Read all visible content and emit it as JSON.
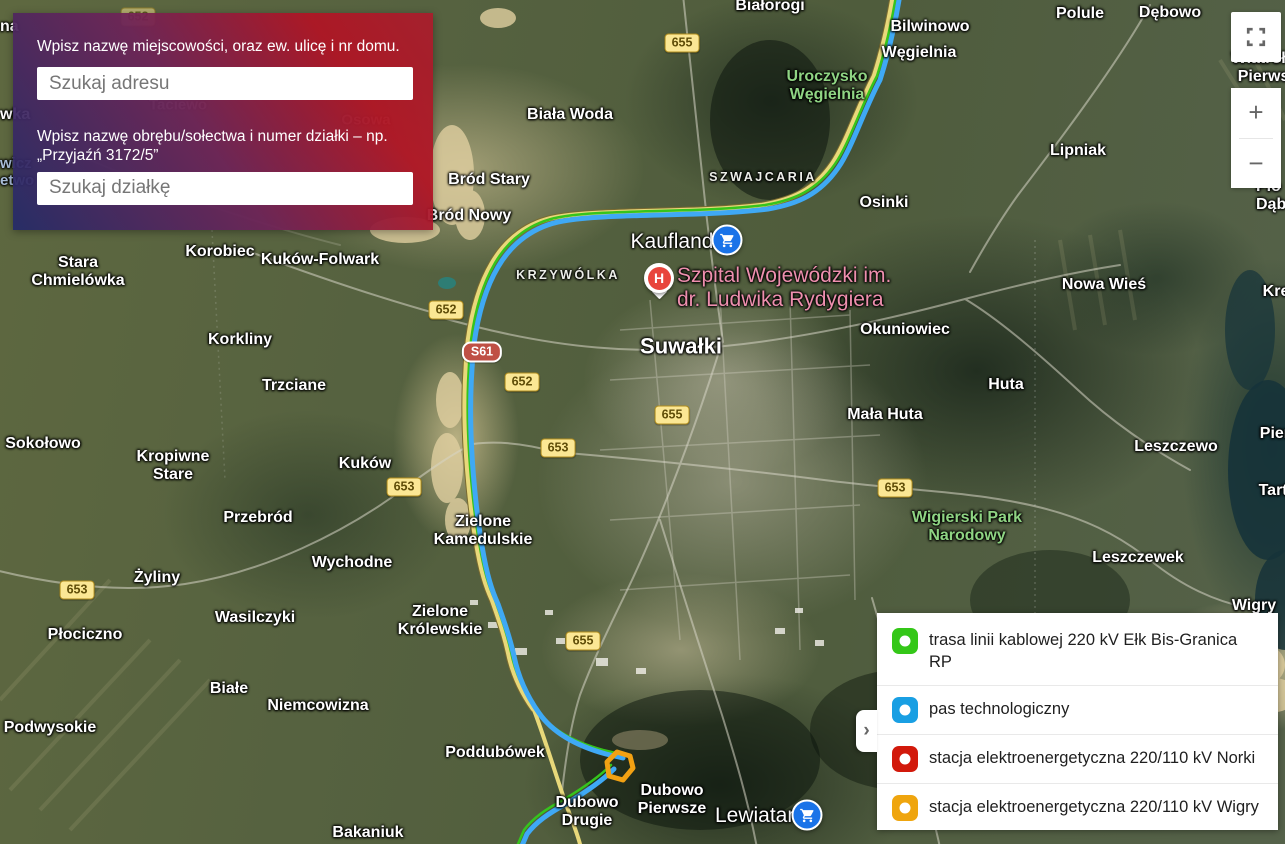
{
  "search_panel": {
    "label_address": "Wpisz nazwę miejscowości, oraz ew. ulicę i nr domu.",
    "address_placeholder": "Szukaj adresu",
    "label_parcel": "Wpisz nazwę obrębu/sołectwa i numer działki – np.\n„Przyjaźń 3172/5”",
    "parcel_placeholder": "Szukaj działkę"
  },
  "legend": {
    "collapse_chevron": "›",
    "items": [
      {
        "color": "#34c718",
        "label": "trasa linii kablowej 220 kV Ełk Bis-Granica RP"
      },
      {
        "color": "#199fe3",
        "label": "pas technologiczny"
      },
      {
        "color": "#d2190b",
        "label": "stacja elektroenergetyczna 220/110 kV Norki"
      },
      {
        "color": "#efa50e",
        "label": "stacja elektroenergetyczna 220/110 kV Wigry"
      }
    ]
  },
  "map_controls": {
    "zoom_in": "+",
    "zoom_out": "−"
  },
  "map": {
    "route_colors": {
      "cable": "#36c41c",
      "pas": "#3fa9f5",
      "station_wigry": "#f2a113"
    },
    "labels": [
      {
        "text": "Stara\nChmielówka",
        "x": 78,
        "y": 272,
        "type": "town"
      },
      {
        "text": "Korobiec",
        "x": 220,
        "y": 252,
        "type": "town"
      },
      {
        "text": "Kuków-Folwark",
        "x": 320,
        "y": 260,
        "type": "town"
      },
      {
        "text": "Korkliny",
        "x": 240,
        "y": 340,
        "type": "town"
      },
      {
        "text": "Trzciane",
        "x": 294,
        "y": 386,
        "type": "town"
      },
      {
        "text": "Sokołowo",
        "x": 43,
        "y": 444,
        "type": "town"
      },
      {
        "text": "Kropiwne\nStare",
        "x": 173,
        "y": 466,
        "type": "town"
      },
      {
        "text": "Kuków",
        "x": 365,
        "y": 464,
        "type": "town"
      },
      {
        "text": "Przebród",
        "x": 258,
        "y": 518,
        "type": "town"
      },
      {
        "text": "Wychodne",
        "x": 352,
        "y": 563,
        "type": "town"
      },
      {
        "text": "Żyliny",
        "x": 157,
        "y": 578,
        "type": "town"
      },
      {
        "text": "Wasilczyki",
        "x": 255,
        "y": 618,
        "type": "town"
      },
      {
        "text": "Płociczno",
        "x": 85,
        "y": 635,
        "type": "town"
      },
      {
        "text": "Białe",
        "x": 229,
        "y": 689,
        "type": "town"
      },
      {
        "text": "Niemcowizna",
        "x": 318,
        "y": 706,
        "type": "town"
      },
      {
        "text": "Podwysokie",
        "x": 50,
        "y": 728,
        "type": "town"
      },
      {
        "text": "Zielone\nKamedulskie",
        "x": 483,
        "y": 531,
        "type": "town"
      },
      {
        "text": "Zielone\nKrólewskie",
        "x": 440,
        "y": 621,
        "type": "town"
      },
      {
        "text": "Poddubówek",
        "x": 495,
        "y": 753,
        "type": "town"
      },
      {
        "text": "Dubowo\nPierwsze",
        "x": 672,
        "y": 800,
        "type": "town"
      },
      {
        "text": "Dubowo\nDrugie",
        "x": 587,
        "y": 812,
        "type": "town"
      },
      {
        "text": "Bakaniuk",
        "x": 368,
        "y": 833,
        "type": "town"
      },
      {
        "text": "Bród Stary",
        "x": 489,
        "y": 180,
        "type": "town"
      },
      {
        "text": "Bród Nowy",
        "x": 469,
        "y": 216,
        "type": "town"
      },
      {
        "text": "Biała Woda",
        "x": 570,
        "y": 115,
        "type": "town"
      },
      {
        "text": "Białorogi",
        "x": 770,
        "y": 6,
        "type": "town"
      },
      {
        "text": "Bilwinowo",
        "x": 930,
        "y": 27,
        "type": "town"
      },
      {
        "text": "Węgielnia",
        "x": 919,
        "y": 53,
        "type": "town"
      },
      {
        "text": "Polule",
        "x": 1080,
        "y": 14,
        "type": "town"
      },
      {
        "text": "Dębowo",
        "x": 1170,
        "y": 13,
        "type": "town"
      },
      {
        "text": "Lipniak",
        "x": 1078,
        "y": 151,
        "type": "town"
      },
      {
        "text": "Osinki",
        "x": 884,
        "y": 203,
        "type": "town"
      },
      {
        "text": "Okuniowiec",
        "x": 905,
        "y": 330,
        "type": "town"
      },
      {
        "text": "Nowa Wieś",
        "x": 1104,
        "y": 285,
        "type": "town"
      },
      {
        "text": "Huta",
        "x": 1006,
        "y": 385,
        "type": "town"
      },
      {
        "text": "Mała Huta",
        "x": 885,
        "y": 415,
        "type": "town"
      },
      {
        "text": "Leszczewo",
        "x": 1176,
        "y": 447,
        "type": "town"
      },
      {
        "text": "Leszczewek",
        "x": 1138,
        "y": 558,
        "type": "town"
      },
      {
        "text": "Wigry",
        "x": 1254,
        "y": 606,
        "type": "town"
      },
      {
        "text": "Tartak",
        "x": 1282,
        "y": 491,
        "type": "town"
      },
      {
        "text": "Pierty",
        "x": 1282,
        "y": 434,
        "type": "town"
      },
      {
        "text": "Kre",
        "x": 1276,
        "y": 292,
        "type": "town"
      },
      {
        "text": "Wiatrołuża\nPierwsza",
        "x": 1272,
        "y": 68,
        "type": "town"
      },
      {
        "text": "Pło\nDąb",
        "x": 1256,
        "y": 196,
        "type": "town",
        "align": "left"
      },
      {
        "text": "na",
        "x": 0,
        "y": 27,
        "type": "town",
        "align": "left"
      },
      {
        "text": "wka",
        "x": 0,
        "y": 115,
        "type": "town",
        "align": "left"
      },
      {
        "text": "wicz\netwo",
        "x": 0,
        "y": 172,
        "type": "water",
        "align": "left"
      },
      {
        "text": "KRZYWÓLKA",
        "x": 568,
        "y": 275,
        "type": "district"
      },
      {
        "text": "SZWAJCARIA",
        "x": 763,
        "y": 177,
        "type": "district"
      },
      {
        "text": "Uroczysko\nWęgielnia",
        "x": 827,
        "y": 86,
        "type": "park"
      },
      {
        "text": "Wigierski Park\nNarodowy",
        "x": 967,
        "y": 527,
        "type": "park"
      },
      {
        "text": "Suwałki",
        "x": 681,
        "y": 346,
        "type": "city"
      },
      {
        "text": "Taciewo",
        "x": 178,
        "y": 105,
        "type": "faint"
      },
      {
        "text": "Osowa",
        "x": 366,
        "y": 120,
        "type": "faint"
      },
      {
        "text": "Kaufland",
        "x": 672,
        "y": 242,
        "type": "poi-white"
      },
      {
        "text": "Lewiatan",
        "x": 757,
        "y": 816,
        "type": "poi-white"
      },
      {
        "text": "Szpital Wojewódzki im.\ndr. Ludwika Rydygiera",
        "x": 677,
        "y": 288,
        "type": "poi-pink",
        "align": "left"
      }
    ],
    "road_badges": [
      {
        "text": "652",
        "x": 138,
        "y": 17,
        "style": "yellow",
        "faint": true
      },
      {
        "text": "655",
        "x": 682,
        "y": 43,
        "style": "yellow"
      },
      {
        "text": "652",
        "x": 446,
        "y": 310,
        "style": "yellow"
      },
      {
        "text": "S61",
        "x": 482,
        "y": 352,
        "style": "red"
      },
      {
        "text": "652",
        "x": 522,
        "y": 382,
        "style": "yellow"
      },
      {
        "text": "655",
        "x": 672,
        "y": 415,
        "style": "yellow"
      },
      {
        "text": "653",
        "x": 558,
        "y": 448,
        "style": "yellow"
      },
      {
        "text": "653",
        "x": 404,
        "y": 487,
        "style": "yellow"
      },
      {
        "text": "653",
        "x": 895,
        "y": 488,
        "style": "yellow"
      },
      {
        "text": "653",
        "x": 77,
        "y": 590,
        "style": "yellow"
      },
      {
        "text": "655",
        "x": 583,
        "y": 641,
        "style": "yellow"
      }
    ],
    "markers": [
      {
        "kind": "cart",
        "name": "kaufland-marker",
        "x": 727,
        "y": 240
      },
      {
        "kind": "cart",
        "name": "lewiatan-marker",
        "x": 807,
        "y": 815
      },
      {
        "kind": "hospital",
        "name": "hospital-marker",
        "x": 659,
        "y": 283,
        "glyph": "H"
      }
    ]
  }
}
